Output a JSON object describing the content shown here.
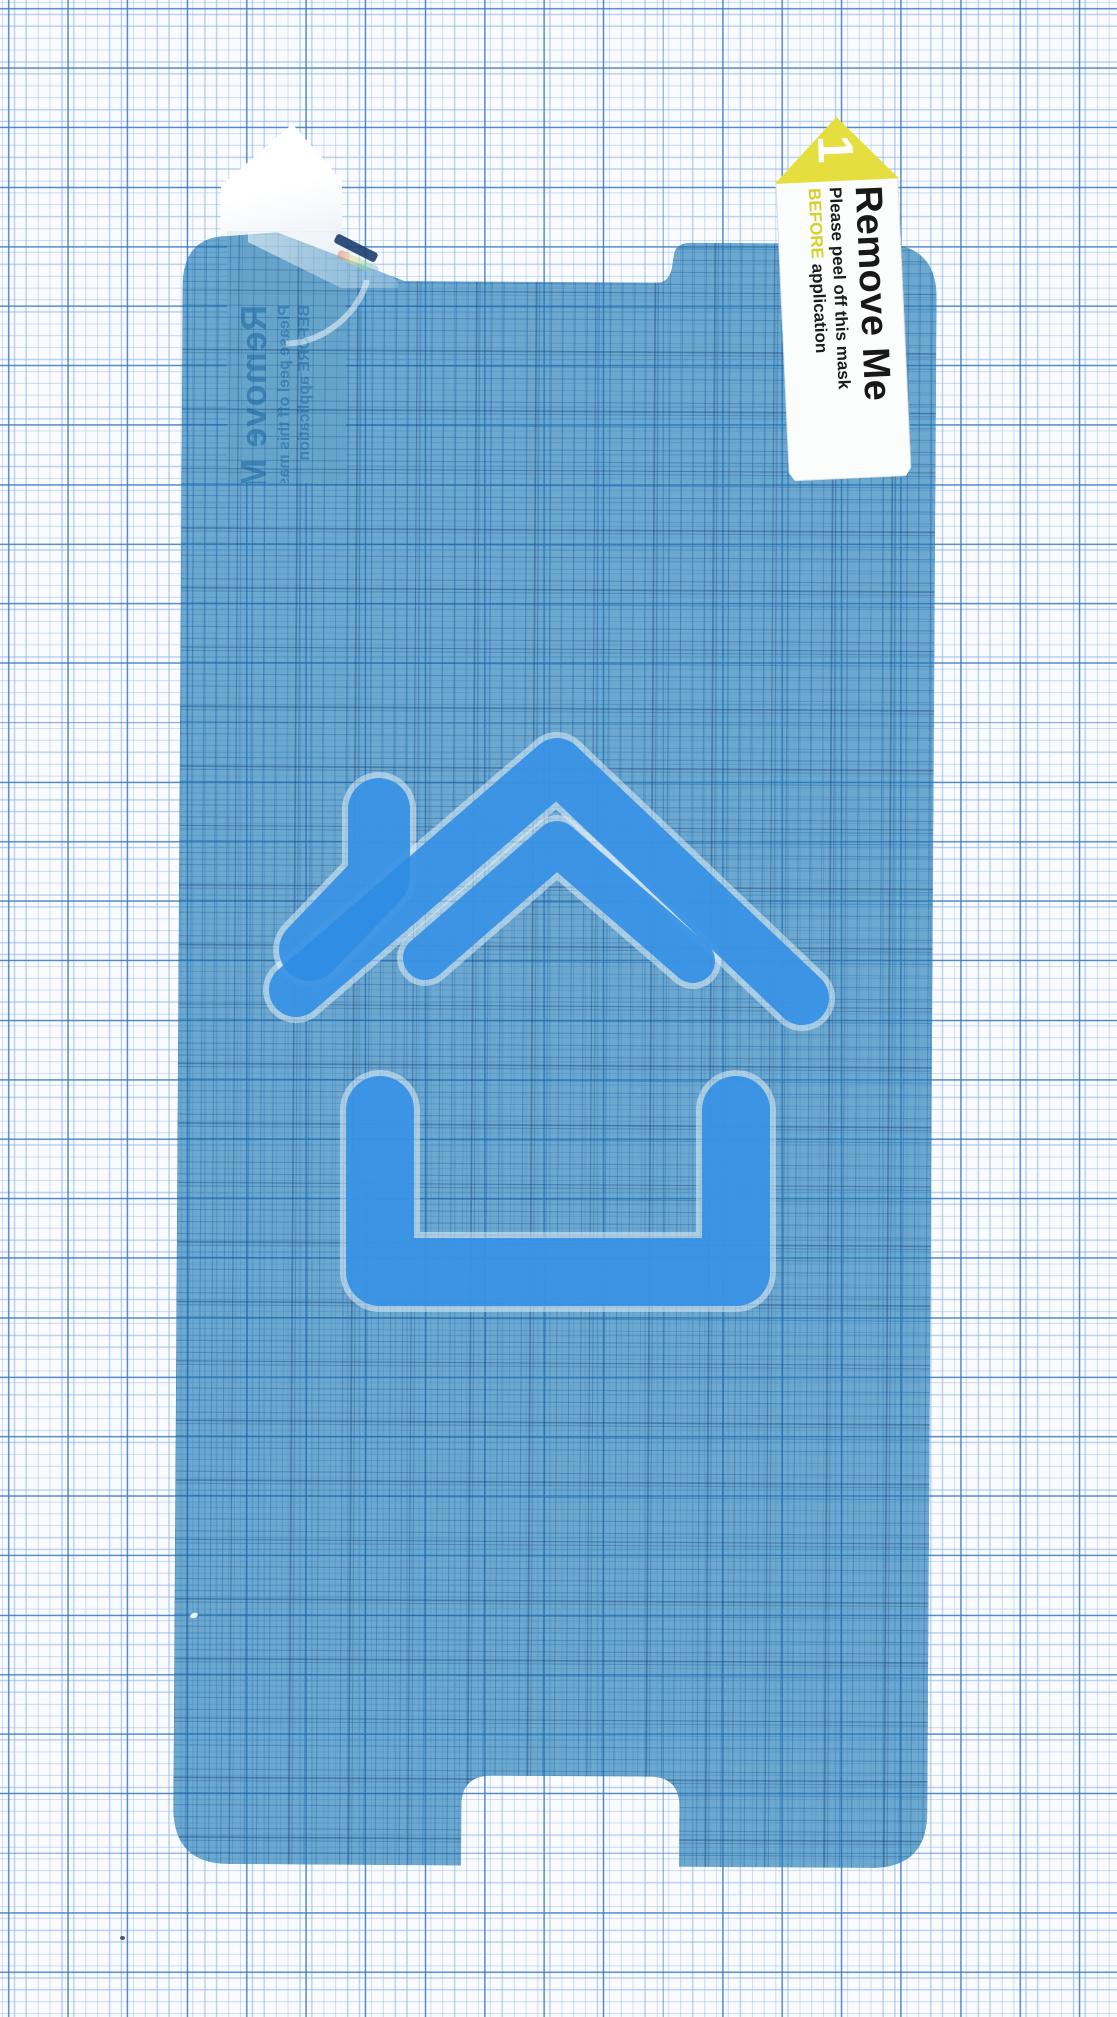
{
  "scene": {
    "description": "Blue protective screen-protector film with peel-off tabs photographed on millimeter graph paper",
    "paper": {
      "minor_line_color": "#91b6e0",
      "major_line_color": "#3776bc",
      "background": "#f9fbfe"
    },
    "film": {
      "color": "#1a76b3"
    }
  },
  "icon": {
    "name": "home-icon",
    "color": "#2d8ce4"
  },
  "labels": {
    "right_tab": {
      "step_number": "1",
      "title": "Remove Me",
      "line1": "Please peel off this mask",
      "line2_highlight": "BEFORE",
      "line2_rest": " application",
      "accent_color": "#e4df3f"
    },
    "left_tab": {
      "mirrored": true,
      "title": "Remove Me",
      "line1": "Please peel off this mask",
      "line2_highlight": "BEFORE",
      "line2_rest": " application"
    }
  }
}
